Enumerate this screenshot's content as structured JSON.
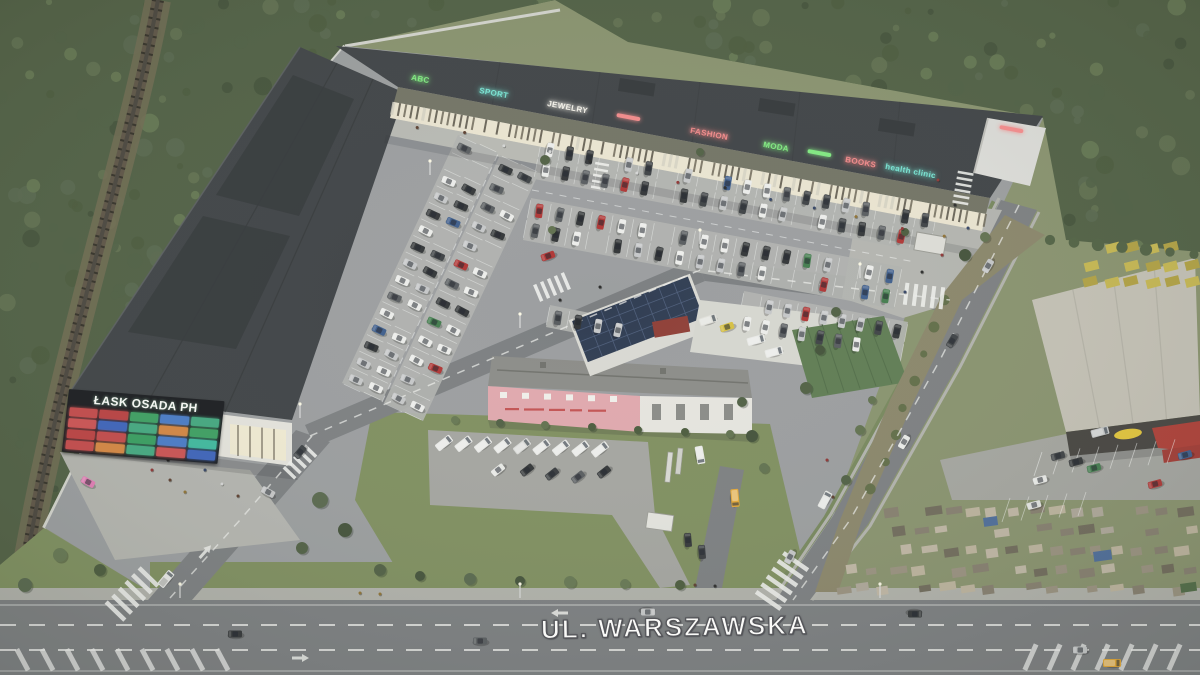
{
  "scene": {
    "title": "ŁASK OSADA PH retail park – aerial visualization",
    "street_label": "UL. WARSZAWSKA"
  },
  "pylon_sign": {
    "title": "ŁASK OSADA PH",
    "tile_colors": [
      "#c05050",
      "#b84848",
      "#44a066",
      "#4f7ec4",
      "#4aa882",
      "#c85858",
      "#4468b8",
      "#4aa882",
      "#d08848",
      "#44a066",
      "#b84848",
      "#c05050",
      "#3f9e64",
      "#4f7ec4",
      "#46b89e",
      "#c05050",
      "#d08848",
      "#4aa882",
      "#c85858",
      "#4468b8"
    ]
  },
  "facade_signs": [
    {
      "label": "ABC",
      "color": "#84e884"
    },
    {
      "label": "SPORT",
      "color": "#7ce2d2"
    },
    {
      "label": "JEWELRY",
      "color": "#f2f0e8"
    },
    {
      "label": "",
      "color": "#ef8d8d"
    },
    {
      "label": "FASHION",
      "color": "#ef8d8d"
    },
    {
      "label": "MODA",
      "color": "#84e884"
    },
    {
      "label": "",
      "color": "#84e884"
    },
    {
      "label": "BOOKS",
      "color": "#ef8d8d"
    },
    {
      "label": "health clinic",
      "color": "#7ce2d2"
    },
    {
      "label": "",
      "color": "#ef8d8d"
    }
  ],
  "palette": {
    "forest": "#4d5c40",
    "forest_dark": "#3f4e35",
    "forest_light": "#5e6e4c",
    "grass": "#7e8e5c",
    "site_paving": "#9b9da0",
    "road": "#7b7d80",
    "sidewalk": "#b2b2ac",
    "roof_dark": "#3a3d41",
    "roof_panel": "#2f3236",
    "fascia": "#707062",
    "storefront_lit": "#efe8d4",
    "walk": "#babab5",
    "plaza": "#b6b6b1",
    "pink_wall": "#e3a8ae",
    "white_wall": "#e9e7e2",
    "solar": "#2c3850",
    "tarp_green": "#5c7a50",
    "store_roof": "#c7c3b8",
    "store_fascia": "#423f3c",
    "logo_yellow": "#e8c838",
    "stack_yellow": "#c9b94e",
    "marking_white": "#f2f2f0",
    "car_colors": [
      "#f0f0ee",
      "#c8c9cb",
      "#55585c",
      "#2e3033",
      "#3a3d41",
      "#b03030",
      "#3a5a8c",
      "#3f7a4a"
    ],
    "van_white": "#ececea",
    "van_yellow": "#e8a832",
    "pink_car": "#e87cb8"
  }
}
